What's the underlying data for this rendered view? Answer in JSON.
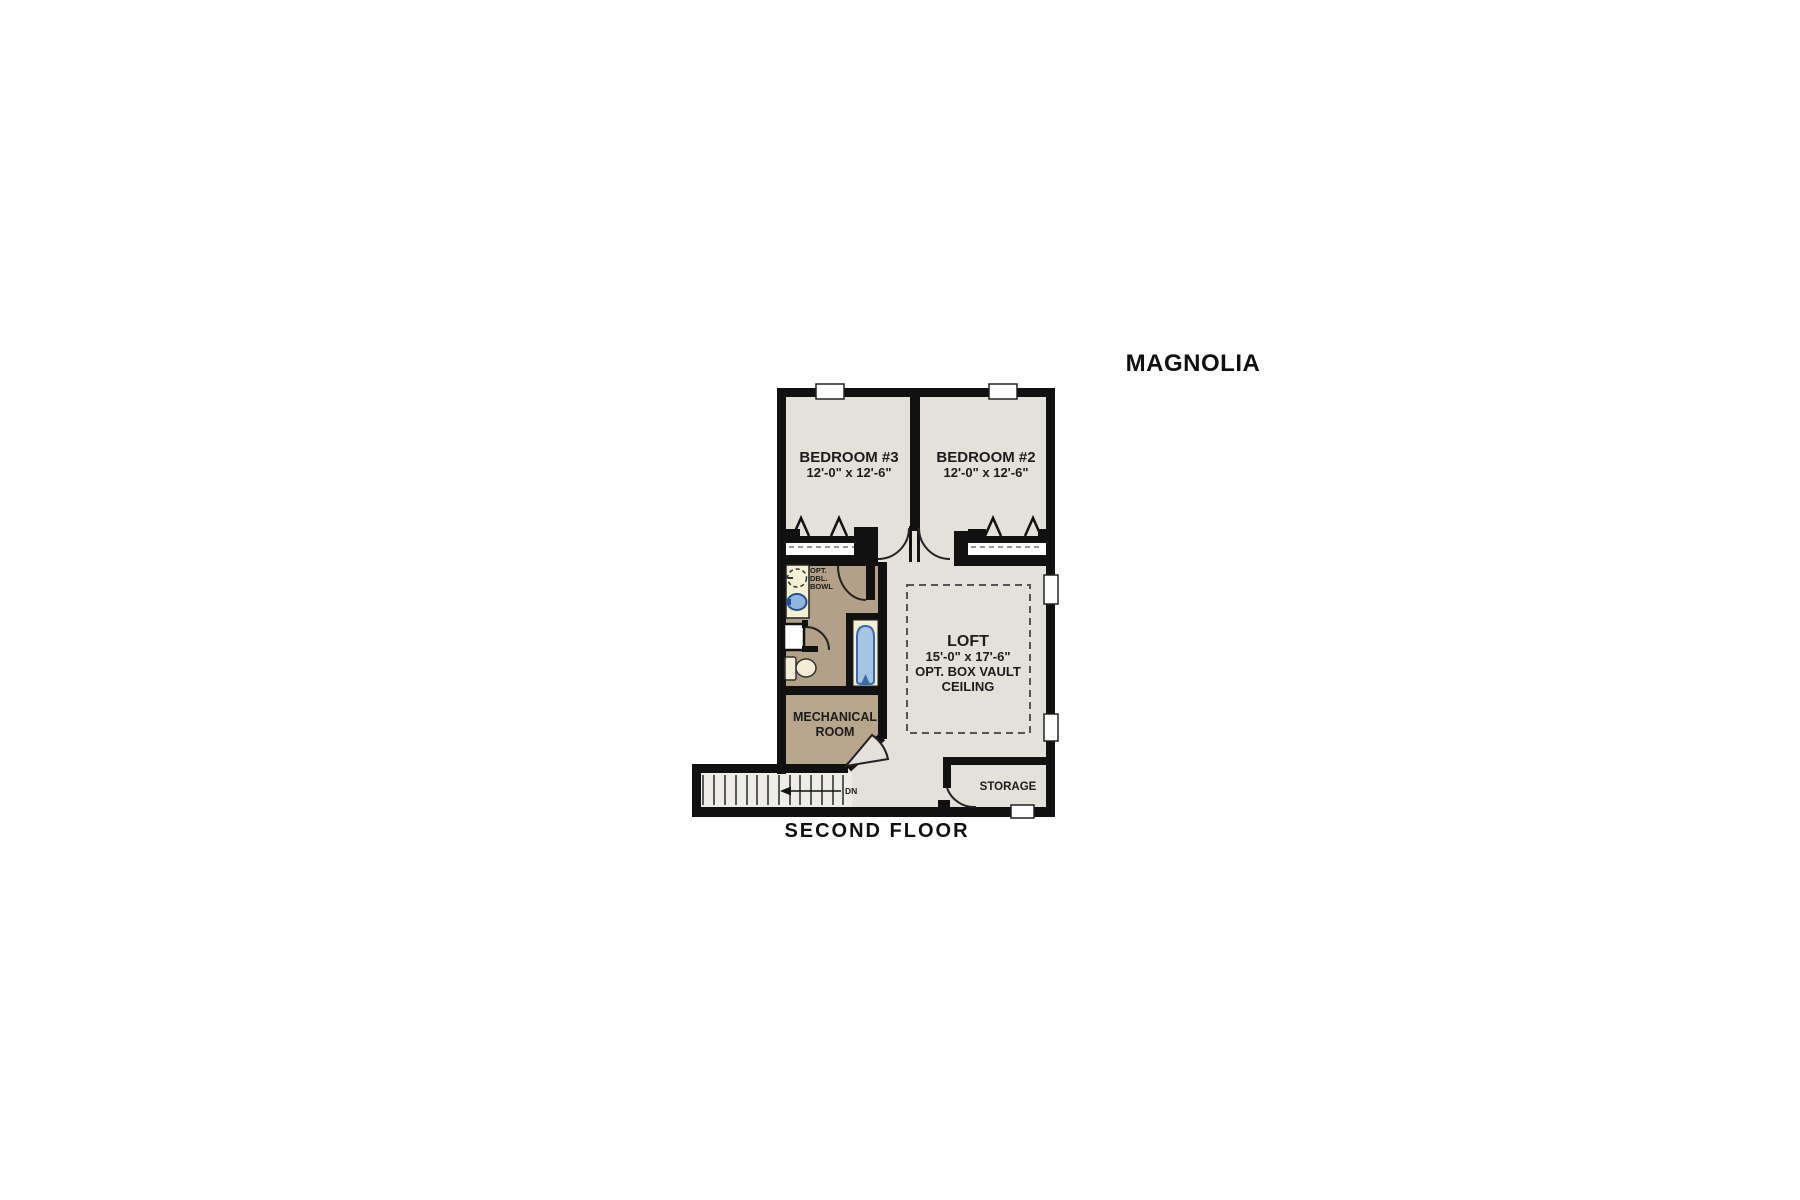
{
  "title": "MAGNOLIA",
  "floor_label": "SECOND FLOOR",
  "rooms": {
    "bedroom3": {
      "name": "BEDROOM #3",
      "dims": "12'-0\" x 12'-6\""
    },
    "bedroom2": {
      "name": "BEDROOM #2",
      "dims": "12'-0\" x 12'-6\""
    },
    "loft": {
      "name": "LOFT",
      "dims": "15'-0\" x 17'-6\"",
      "note_line1": "OPT. BOX VAULT",
      "note_line2": "CEILING"
    },
    "mechanical_room": {
      "line1": "MECHANICAL",
      "line2": "ROOM"
    },
    "storage": {
      "name": "STORAGE"
    },
    "bathroom": {
      "opt_line1": "OPT.",
      "opt_line2": "DBL.",
      "opt_line3": "BOWL"
    }
  },
  "stairs": {
    "down_label": "DN"
  },
  "colors": {
    "wall": "#111111",
    "floor": "#e4e1db",
    "stair_floor": "#eeece7",
    "bath_floor": "#b2a089",
    "mech_floor": "#b7a58c",
    "fixture_cream": "#f5efd4",
    "sink_blue": "#8fb6e0",
    "tub_blue": "#a6c4e4",
    "tub_outline": "#3c6ca8"
  }
}
